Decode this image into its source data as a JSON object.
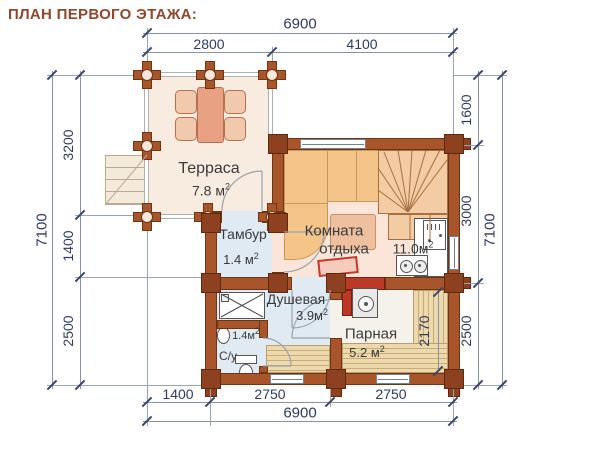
{
  "title": "ПЛАН ПЕРВОГО ЭТАЖА:",
  "sup2": "2",
  "dims": {
    "top_total": "6900",
    "top_seg1": "2800",
    "top_seg2": "4100",
    "left_total": "7100",
    "left_seg1": "3200",
    "left_seg2": "1400",
    "left_seg3": "2500",
    "right_seg1": "1600",
    "right_seg2": "3000",
    "right_seg3": "2500",
    "right_total": "7100",
    "bottom_seg1": "1400",
    "bottom_seg2": "2750",
    "bottom_seg3": "2750",
    "bottom_total": "6900",
    "sauna_width": "2170"
  },
  "rooms": {
    "terrace": {
      "name": "Терраса",
      "area": "7.8 м"
    },
    "tambur": {
      "name": "Тамбур",
      "area": "1.4 м"
    },
    "lounge": {
      "name1": "Комната",
      "name2": "отдыха",
      "area": "11.0м"
    },
    "shower": {
      "name": "Душевая",
      "area": "3.9м"
    },
    "wc": {
      "name": "С/у",
      "area": "1.4м"
    },
    "sauna": {
      "name": "Парная",
      "area": "5.2 м"
    }
  },
  "colors": {
    "wall_brown": "#a9552b",
    "post_brown": "#8d4120",
    "stove_red": "#bb3a27",
    "dim_text": "#2f3a5f",
    "title_brown": "#8a4a2e",
    "wet_floor_blue": "#dfeaf3",
    "lounge_floor_pink": "#fbe5d8"
  }
}
